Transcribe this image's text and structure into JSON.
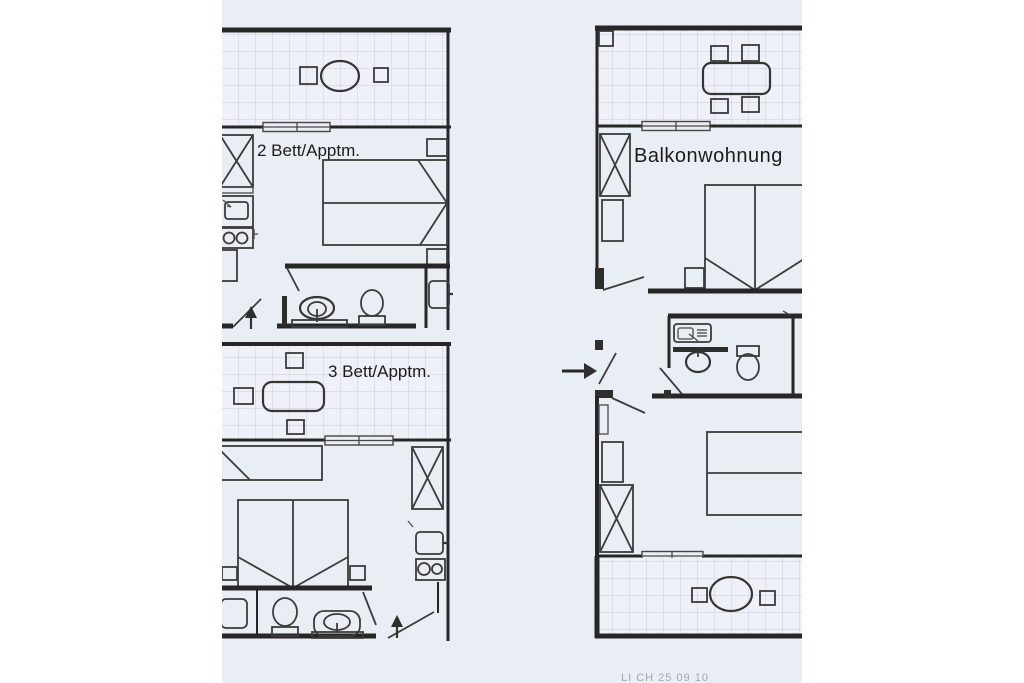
{
  "labels": {
    "apartment_2bed": "2 Bett/Apptm.",
    "apartment_3bed": "3 Bett/Apptm.",
    "apartment_balcony": "Balkonwohnung",
    "footer_code": "LI CH 25 09 10"
  },
  "colors": {
    "margin": "#ffffff",
    "paper": "#e9edf4",
    "tile_fill": "#eef1f7",
    "tile_grid": "#c5cdd9",
    "wall": "#282828",
    "furniture_line": "#3b3b3b",
    "text": "#1b1b1b",
    "footer_text": "#8b909a"
  },
  "icons": {
    "entrance_arrow_2bed": "arrow-up",
    "entrance_arrow_3bed": "arrow-up",
    "entrance_arrow_balcony": "arrow-right"
  }
}
